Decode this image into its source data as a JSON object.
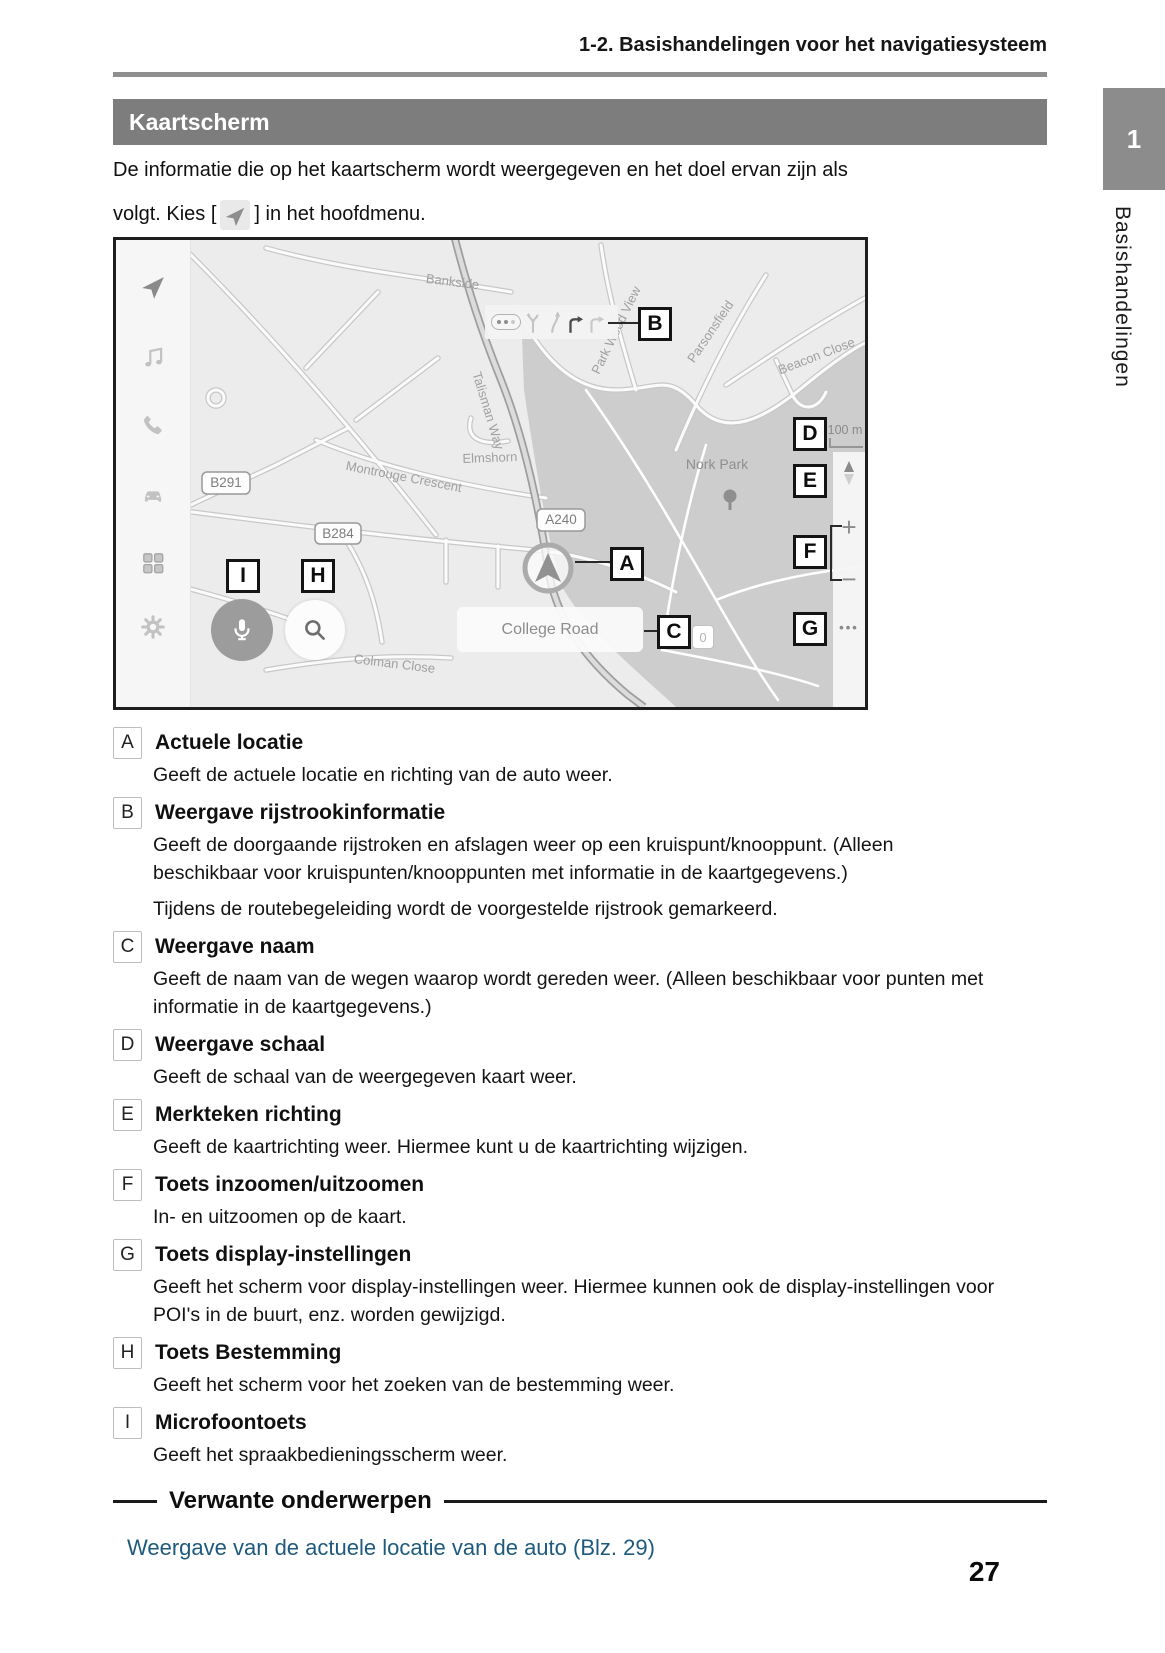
{
  "page": {
    "header": "1-2. Basishandelingen voor het navigatiesysteem",
    "title_bar": "Kaartscherm",
    "intro_line1": "De informatie die op het kaartscherm wordt weergegeven en het doel ervan zijn als",
    "intro_line2_pre": "volgt. Kies [",
    "intro_line2_post": "] in het hoofdmenu.",
    "chapter_tab": "1",
    "chapter_side_label": "Basishandelingen",
    "page_number": "27"
  },
  "map": {
    "scale_label": "100 m",
    "street_bar": "College Road",
    "counter_badge": "0",
    "zoom_in": "+",
    "zoom_out": "−",
    "options_dots": "•••",
    "badges": {
      "b291": "B291",
      "b284": "B284",
      "a240": "A240"
    },
    "labels": {
      "bankside": "Bankside",
      "talisman": "Talisman Way",
      "montrouge": "Montrouge Crescent",
      "elmshorn": "Elmshorn",
      "nork_park": "Nork Park",
      "park_wood_view": "Park Wood View",
      "parsonsfield": "Parsonsfield",
      "beacon_close": "Beacon Close",
      "colman_close": "Colman Close"
    },
    "callouts": {
      "a": "A",
      "b": "B",
      "c": "C",
      "d": "D",
      "e": "E",
      "f": "F",
      "g": "G",
      "h": "H",
      "i": "I"
    },
    "colors": {
      "park_fill": "#cdcdcd",
      "road_casing": "#c8c8c8",
      "main_road": "#9e9e9e",
      "label_gray": "#a0a0a0"
    }
  },
  "sections": [
    {
      "letter": "A",
      "title": "Actuele locatie",
      "paragraphs": [
        "Geeft de actuele locatie en richting van de auto weer."
      ]
    },
    {
      "letter": "B",
      "title": "Weergave rijstrookinformatie",
      "paragraphs": [
        "Geeft de doorgaande rijstroken en afslagen weer op een kruispunt/knooppunt. (Alleen beschikbaar voor kruispunten/knooppunten met informatie in de kaartgegevens.)",
        "Tijdens de routebegeleiding wordt de voorgestelde rijstrook gemarkeerd."
      ]
    },
    {
      "letter": "C",
      "title": "Weergave naam",
      "paragraphs": [
        "Geeft de naam van de wegen waarop wordt gereden weer. (Alleen beschikbaar voor punten met informatie in de kaartgegevens.)"
      ]
    },
    {
      "letter": "D",
      "title": "Weergave schaal",
      "paragraphs": [
        "Geeft de schaal van de weergegeven kaart weer."
      ]
    },
    {
      "letter": "E",
      "title": "Merkteken richting",
      "paragraphs": [
        "Geeft de kaartrichting weer. Hiermee kunt u de kaartrichting wijzigen."
      ]
    },
    {
      "letter": "F",
      "title": "Toets inzoomen/uitzoomen",
      "paragraphs": [
        "In- en uitzoomen op de kaart."
      ]
    },
    {
      "letter": "G",
      "title": "Toets display-instellingen",
      "paragraphs": [
        "Geeft het scherm voor display-instellingen weer. Hiermee kunnen ook de display-instellingen voor POI's in de buurt, enz. worden gewijzigd."
      ]
    },
    {
      "letter": "H",
      "title": "Toets Bestemming",
      "paragraphs": [
        "Geeft het scherm voor het zoeken van de bestemming weer."
      ]
    },
    {
      "letter": "I",
      "title": "Microfoontoets",
      "paragraphs": [
        "Geeft het spraakbedieningsscherm weer."
      ]
    }
  ],
  "related": {
    "heading": "Verwante onderwerpen",
    "link": "Weergave van de actuele locatie van de auto (Blz. 29)"
  }
}
